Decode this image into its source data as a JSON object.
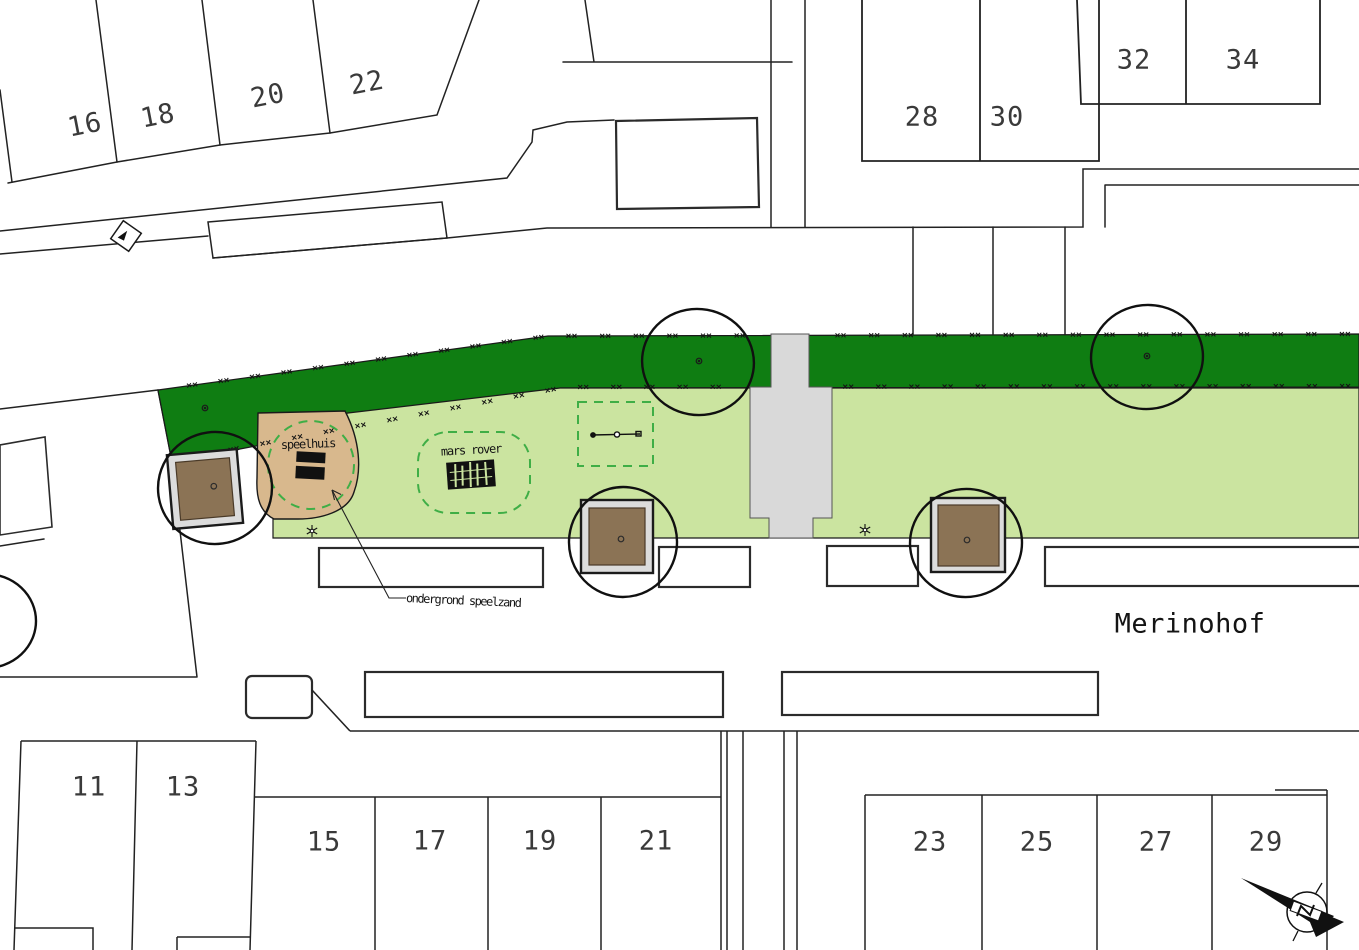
{
  "map": {
    "street_label": "Merinohof",
    "annotations": {
      "speelhuis": "speelhuis",
      "mars_rover": "mars rover",
      "surface_note": "ondergrond speelzand"
    },
    "house_numbers": {
      "top_left": [
        "16",
        "18",
        "20",
        "22"
      ],
      "top_right": [
        "28",
        "30",
        "32",
        "34"
      ],
      "bottom_left": [
        "11",
        "13",
        "15",
        "17",
        "19",
        "21"
      ],
      "bottom_right": [
        "23",
        "25",
        "27",
        "29"
      ]
    },
    "colors": {
      "hedge_green": "#0f7d12",
      "grass_green": "#cbe4a0",
      "sand_surface_tan": "#d8b88d",
      "sandbox_sand_brown": "#8b7355",
      "sandbox_frame_grey": "#dcdcdc",
      "path_grey": "#d9d9d9",
      "dashed_green": "#3fae46",
      "line_black": "#1e1e1e"
    }
  }
}
